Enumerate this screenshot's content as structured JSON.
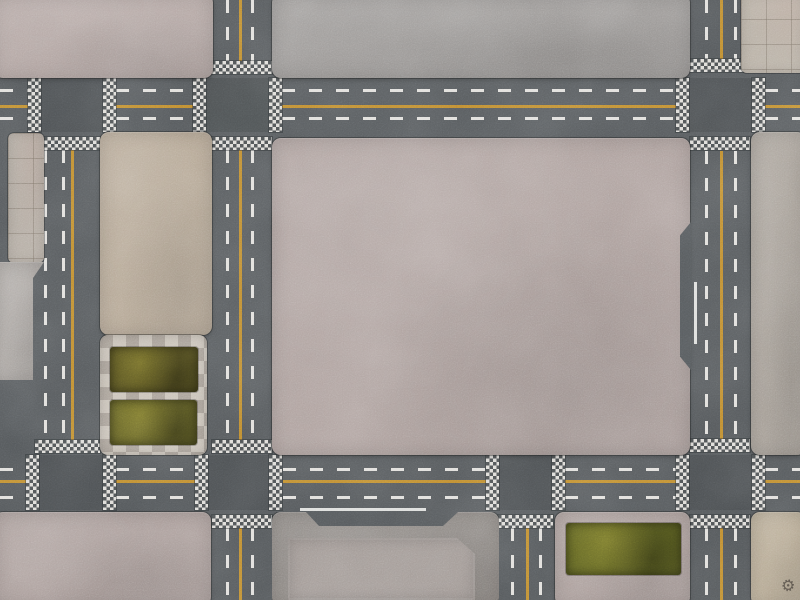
{
  "scene": {
    "kind": "top-down city street map (modular battle-mat style)",
    "width_px": 800,
    "height_px": 600,
    "features": "asphalt roads with solid yellow center lines and dashed white lane lines, checkered pedestrian crossings at junctions, concrete city blocks, tiled plaza corners, planter with grass beds, grass rectangle, small gear logo stamp"
  },
  "palette": {
    "asphalt": "#53575a",
    "marking_white": "#eceae6",
    "marking_yellow": "#c7902f",
    "crosswalk_light": "#dedcd8",
    "crosswalk_dark": "#4c5052",
    "concrete_pink": "#b3a6a3",
    "concrete_gray": "#9c9997",
    "concrete_tan": "#b5a795",
    "tile_pavement": "#b2aaa1",
    "planter_light": "#c9c2b8",
    "grass_dark_olive": "#534e1f",
    "grass_light_olive": "#5e5c24",
    "stamp_color": "#453f39"
  },
  "roads": {
    "horizontal": [
      {
        "name": "road-h-top",
        "y": 78,
        "height": 54
      },
      {
        "name": "road-h-bottom",
        "y": 455,
        "height": 55
      }
    ],
    "vertical": [
      {
        "name": "road-v-left",
        "x": 44,
        "width": 56,
        "extent": "between the two horizontal roads"
      },
      {
        "name": "road-v-mid-left",
        "x": 212,
        "width": 60,
        "extent": "full height"
      },
      {
        "name": "road-v-mid-right",
        "x": 498,
        "width": 55,
        "extent": "below bottom road only"
      },
      {
        "name": "road-v-right",
        "x": 690,
        "width": 60,
        "extent": "full height"
      }
    ]
  },
  "elements": [
    {
      "n": "intersection-shade",
      "c": "ix",
      "x": 30,
      "y": 78,
      "w": 75,
      "h": 54
    },
    {
      "n": "intersection-shade",
      "c": "ix",
      "x": 206,
      "y": 78,
      "w": 63,
      "h": 54
    },
    {
      "n": "intersection-shade",
      "c": "ix",
      "x": 688,
      "y": 78,
      "w": 64,
      "h": 54
    },
    {
      "n": "intersection-shade",
      "c": "ix",
      "x": 26,
      "y": 455,
      "w": 77,
      "h": 55
    },
    {
      "n": "intersection-shade",
      "c": "ix",
      "x": 208,
      "y": 455,
      "w": 61,
      "h": 55
    },
    {
      "n": "intersection-shade",
      "c": "ix",
      "x": 498,
      "y": 455,
      "w": 54,
      "h": 55
    },
    {
      "n": "intersection-shade",
      "c": "ix",
      "x": 688,
      "y": 455,
      "w": 64,
      "h": 55
    },
    {
      "n": "lane-dash",
      "c": "dh",
      "x": 0,
      "y": 89,
      "w": 28,
      "h": 3
    },
    {
      "n": "lane-dash",
      "c": "dh",
      "x": 116,
      "y": 89,
      "w": 77,
      "h": 3
    },
    {
      "n": "lane-dash",
      "c": "dh",
      "x": 282,
      "y": 89,
      "w": 394,
      "h": 3
    },
    {
      "n": "lane-dash",
      "c": "dh",
      "x": 765,
      "y": 89,
      "w": 35,
      "h": 3
    },
    {
      "n": "center-line",
      "c": "yh",
      "x": 0,
      "y": 105,
      "w": 28,
      "h": 3
    },
    {
      "n": "center-line",
      "c": "yh",
      "x": 116,
      "y": 105,
      "w": 77,
      "h": 3
    },
    {
      "n": "center-line",
      "c": "yh",
      "x": 282,
      "y": 105,
      "w": 394,
      "h": 3
    },
    {
      "n": "center-line",
      "c": "yh",
      "x": 765,
      "y": 105,
      "w": 35,
      "h": 3
    },
    {
      "n": "lane-dash",
      "c": "dh",
      "x": 0,
      "y": 117,
      "w": 28,
      "h": 3
    },
    {
      "n": "lane-dash",
      "c": "dh",
      "x": 116,
      "y": 117,
      "w": 77,
      "h": 3
    },
    {
      "n": "lane-dash",
      "c": "dh",
      "x": 282,
      "y": 117,
      "w": 394,
      "h": 3
    },
    {
      "n": "lane-dash",
      "c": "dh",
      "x": 765,
      "y": 117,
      "w": 35,
      "h": 3
    },
    {
      "n": "lane-dash",
      "c": "dh",
      "x": 0,
      "y": 468,
      "w": 26,
      "h": 3
    },
    {
      "n": "lane-dash",
      "c": "dh",
      "x": 116,
      "y": 468,
      "w": 79,
      "h": 3
    },
    {
      "n": "lane-dash",
      "c": "dh",
      "x": 283,
      "y": 468,
      "w": 203,
      "h": 3
    },
    {
      "n": "lane-dash",
      "c": "dh",
      "x": 565,
      "y": 468,
      "w": 111,
      "h": 3
    },
    {
      "n": "lane-dash",
      "c": "dh",
      "x": 765,
      "y": 468,
      "w": 35,
      "h": 3
    },
    {
      "n": "center-line",
      "c": "yh",
      "x": 0,
      "y": 480,
      "w": 26,
      "h": 3
    },
    {
      "n": "center-line",
      "c": "yh",
      "x": 116,
      "y": 480,
      "w": 79,
      "h": 3
    },
    {
      "n": "center-line",
      "c": "yh",
      "x": 283,
      "y": 480,
      "w": 203,
      "h": 3
    },
    {
      "n": "center-line",
      "c": "yh",
      "x": 565,
      "y": 480,
      "w": 111,
      "h": 3
    },
    {
      "n": "center-line",
      "c": "yh",
      "x": 765,
      "y": 480,
      "w": 35,
      "h": 3
    },
    {
      "n": "lane-dash",
      "c": "dh",
      "x": 0,
      "y": 496,
      "w": 26,
      "h": 3
    },
    {
      "n": "lane-dash",
      "c": "dh",
      "x": 116,
      "y": 496,
      "w": 79,
      "h": 3
    },
    {
      "n": "lane-dash",
      "c": "dh",
      "x": 283,
      "y": 496,
      "w": 203,
      "h": 3
    },
    {
      "n": "lane-dash",
      "c": "dh",
      "x": 565,
      "y": 496,
      "w": 111,
      "h": 3
    },
    {
      "n": "lane-dash",
      "c": "dh",
      "x": 765,
      "y": 496,
      "w": 35,
      "h": 3
    },
    {
      "n": "lane-dash",
      "c": "dv",
      "x": 44,
      "y": 150,
      "w": 3,
      "h": 290
    },
    {
      "n": "lane-dash",
      "c": "dv",
      "x": 62,
      "y": 150,
      "w": 3,
      "h": 290
    },
    {
      "n": "center-line",
      "c": "yv",
      "x": 71,
      "y": 150,
      "w": 3,
      "h": 290
    },
    {
      "n": "lane-dash",
      "c": "dv",
      "x": 226,
      "y": 0,
      "w": 3,
      "h": 61
    },
    {
      "n": "lane-dash",
      "c": "dv",
      "x": 226,
      "y": 150,
      "w": 3,
      "h": 290
    },
    {
      "n": "lane-dash",
      "c": "dv",
      "x": 226,
      "y": 528,
      "w": 3,
      "h": 72
    },
    {
      "n": "center-line",
      "c": "yv",
      "x": 239,
      "y": 0,
      "w": 3,
      "h": 61
    },
    {
      "n": "center-line",
      "c": "yv",
      "x": 239,
      "y": 150,
      "w": 3,
      "h": 290
    },
    {
      "n": "center-line",
      "c": "yv",
      "x": 239,
      "y": 528,
      "w": 3,
      "h": 72
    },
    {
      "n": "lane-dash",
      "c": "dv",
      "x": 251,
      "y": 0,
      "w": 3,
      "h": 61
    },
    {
      "n": "lane-dash",
      "c": "dv",
      "x": 251,
      "y": 150,
      "w": 3,
      "h": 290
    },
    {
      "n": "lane-dash",
      "c": "dv",
      "x": 251,
      "y": 528,
      "w": 3,
      "h": 72
    },
    {
      "n": "lane-dash",
      "c": "dv",
      "x": 511,
      "y": 528,
      "w": 3,
      "h": 72
    },
    {
      "n": "center-line",
      "c": "yv",
      "x": 526,
      "y": 528,
      "w": 3,
      "h": 72
    },
    {
      "n": "lane-dash",
      "c": "dv",
      "x": 539,
      "y": 528,
      "w": 3,
      "h": 72
    },
    {
      "n": "lane-dash",
      "c": "dv",
      "x": 705,
      "y": 0,
      "w": 3,
      "h": 59
    },
    {
      "n": "lane-dash",
      "c": "dv",
      "x": 705,
      "y": 151,
      "w": 3,
      "h": 288
    },
    {
      "n": "lane-dash",
      "c": "dv",
      "x": 705,
      "y": 528,
      "w": 3,
      "h": 72
    },
    {
      "n": "center-line",
      "c": "yv",
      "x": 720,
      "y": 0,
      "w": 3,
      "h": 59
    },
    {
      "n": "center-line",
      "c": "yv",
      "x": 720,
      "y": 151,
      "w": 3,
      "h": 288
    },
    {
      "n": "center-line",
      "c": "yv",
      "x": 720,
      "y": 528,
      "w": 3,
      "h": 72
    },
    {
      "n": "lane-dash",
      "c": "dv",
      "x": 734,
      "y": 0,
      "w": 3,
      "h": 59
    },
    {
      "n": "lane-dash",
      "c": "dv",
      "x": 734,
      "y": 151,
      "w": 3,
      "h": 288
    },
    {
      "n": "lane-dash",
      "c": "dv",
      "x": 734,
      "y": 528,
      "w": 3,
      "h": 72
    },
    {
      "n": "stop-line",
      "c": "wl",
      "x": 300,
      "y": 508,
      "w": 126,
      "h": 3
    },
    {
      "n": "edge-line",
      "c": "wl",
      "x": 694,
      "y": 282,
      "w": 3,
      "h": 62
    },
    {
      "n": "crosswalk",
      "c": "cw",
      "x": 28,
      "y": 78,
      "w": 13,
      "h": 54
    },
    {
      "n": "crosswalk",
      "c": "cw",
      "x": 103,
      "y": 78,
      "w": 13,
      "h": 54
    },
    {
      "n": "crosswalk",
      "c": "cw",
      "x": 193,
      "y": 78,
      "w": 13,
      "h": 54
    },
    {
      "n": "crosswalk",
      "c": "cw",
      "x": 269,
      "y": 78,
      "w": 13,
      "h": 54
    },
    {
      "n": "crosswalk",
      "c": "cw",
      "x": 676,
      "y": 78,
      "w": 13,
      "h": 54
    },
    {
      "n": "crosswalk",
      "c": "cw",
      "x": 752,
      "y": 78,
      "w": 13,
      "h": 54
    },
    {
      "n": "crosswalk",
      "c": "cw",
      "x": 26,
      "y": 455,
      "w": 13,
      "h": 55
    },
    {
      "n": "crosswalk",
      "c": "cw",
      "x": 103,
      "y": 455,
      "w": 13,
      "h": 55
    },
    {
      "n": "crosswalk",
      "c": "cw",
      "x": 195,
      "y": 455,
      "w": 13,
      "h": 55
    },
    {
      "n": "crosswalk",
      "c": "cw",
      "x": 269,
      "y": 455,
      "w": 13,
      "h": 55
    },
    {
      "n": "crosswalk",
      "c": "cw",
      "x": 486,
      "y": 455,
      "w": 13,
      "h": 55
    },
    {
      "n": "crosswalk",
      "c": "cw",
      "x": 552,
      "y": 455,
      "w": 13,
      "h": 55
    },
    {
      "n": "crosswalk",
      "c": "cw",
      "x": 676,
      "y": 455,
      "w": 13,
      "h": 55
    },
    {
      "n": "crosswalk",
      "c": "cw",
      "x": 752,
      "y": 455,
      "w": 13,
      "h": 55
    },
    {
      "n": "crosswalk",
      "c": "cw",
      "x": 44,
      "y": 137,
      "w": 56,
      "h": 13
    },
    {
      "n": "crosswalk",
      "c": "cw",
      "x": 35,
      "y": 440,
      "w": 65,
      "h": 13
    },
    {
      "n": "crosswalk",
      "c": "cw",
      "x": 212,
      "y": 61,
      "w": 60,
      "h": 13
    },
    {
      "n": "crosswalk",
      "c": "cw",
      "x": 212,
      "y": 137,
      "w": 60,
      "h": 13
    },
    {
      "n": "crosswalk",
      "c": "cw",
      "x": 212,
      "y": 440,
      "w": 60,
      "h": 13
    },
    {
      "n": "crosswalk",
      "c": "cw",
      "x": 212,
      "y": 515,
      "w": 60,
      "h": 13
    },
    {
      "n": "crosswalk",
      "c": "cw",
      "x": 498,
      "y": 515,
      "w": 55,
      "h": 13
    },
    {
      "n": "crosswalk",
      "c": "cw",
      "x": 690,
      "y": 59,
      "w": 60,
      "h": 13
    },
    {
      "n": "crosswalk",
      "c": "cw",
      "x": 690,
      "y": 137,
      "w": 60,
      "h": 13
    },
    {
      "n": "crosswalk",
      "c": "cw",
      "x": 690,
      "y": 439,
      "w": 60,
      "h": 13
    },
    {
      "n": "crosswalk",
      "c": "cw",
      "x": 690,
      "y": 515,
      "w": 60,
      "h": 13
    },
    {
      "n": "city-block-top-left",
      "c": "block concrete",
      "x": -6,
      "y": -6,
      "w": 219,
      "h": 84,
      "bg": "#b3a6a3"
    },
    {
      "n": "city-block-top-mid",
      "c": "block concrete",
      "x": 272,
      "y": -6,
      "w": 418,
      "h": 84,
      "bg": "#9c9997"
    },
    {
      "n": "plaza-tiles-top-right",
      "c": "tiles",
      "x": 741,
      "y": -6,
      "w": 65,
      "h": 79,
      "bg": "#b9b1a6"
    },
    {
      "n": "sidewalk-tiles-left",
      "c": "tiles",
      "x": 8,
      "y": 133,
      "w": 36,
      "h": 130,
      "bg": "#b2aaa1"
    },
    {
      "n": "sidewalk-concrete-left",
      "c": "block concrete swc",
      "x": -6,
      "y": 262,
      "w": 50,
      "h": 118,
      "bg": "#a9a4a0"
    },
    {
      "n": "city-block-tan",
      "c": "block concrete",
      "x": 100,
      "y": 132,
      "w": 112,
      "h": 203,
      "bg": "#b5a795"
    },
    {
      "n": "planter-frame",
      "c": "planter",
      "x": 100,
      "y": 335,
      "w": 107,
      "h": 120
    },
    {
      "n": "grass-patch",
      "c": "grass",
      "x": 110,
      "y": 347,
      "w": 88,
      "h": 45,
      "bg": "#534e1f"
    },
    {
      "n": "grass-patch",
      "c": "grass",
      "x": 110,
      "y": 400,
      "w": 87,
      "h": 45,
      "bg": "#5e5c24"
    },
    {
      "n": "city-block-center",
      "c": "block concrete",
      "x": 272,
      "y": 138,
      "w": 418,
      "h": 317,
      "bg": "#aea19e"
    },
    {
      "n": "asphalt-notch",
      "c": "notch",
      "x": 680,
      "y": 222,
      "w": 11,
      "h": 148,
      "bg": "#53575a"
    },
    {
      "n": "city-block-right",
      "c": "block concrete",
      "x": 751,
      "y": 132,
      "w": 55,
      "h": 323,
      "bg": "#a7a098"
    },
    {
      "n": "city-block-bottom-left",
      "c": "block concrete",
      "x": -6,
      "y": 512,
      "w": 217,
      "h": 94,
      "bg": "#aa9d9a"
    },
    {
      "n": "city-block-bottom-mid",
      "c": "block concrete bm",
      "x": 272,
      "y": 512,
      "w": 227,
      "h": 94,
      "bg": "#8d8884"
    },
    {
      "n": "roof-panel",
      "c": "panel",
      "x": 288,
      "y": 538,
      "w": 187,
      "h": 62,
      "bg": "#a29a96"
    },
    {
      "n": "city-block-bottom-grass",
      "c": "block concrete",
      "x": 555,
      "y": 512,
      "w": 135,
      "h": 94,
      "bg": "#ab9e9b"
    },
    {
      "n": "grass-patch",
      "c": "grass",
      "x": 566,
      "y": 523,
      "w": 115,
      "h": 52,
      "bg": "#585c1f"
    },
    {
      "n": "city-block-bottom-right",
      "c": "block concrete",
      "x": 751,
      "y": 512,
      "w": 55,
      "h": 94,
      "bg": "#b7aa94"
    },
    {
      "n": "gear-logo-icon",
      "c": "stamp",
      "x": 779,
      "y": 577,
      "w": 18,
      "h": 18,
      "glyph": "⚙"
    }
  ]
}
